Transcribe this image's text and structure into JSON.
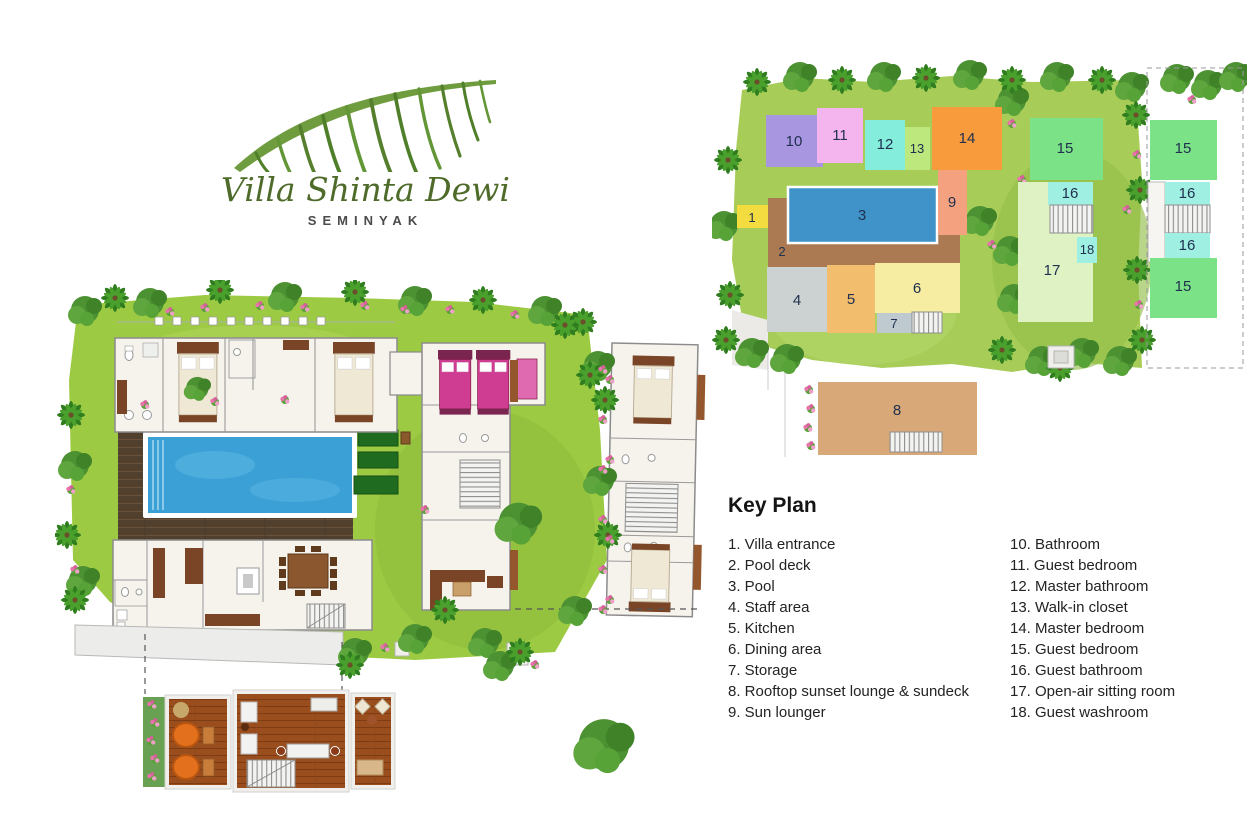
{
  "logo": {
    "title": "Villa Shinta Dewi",
    "subtitle": "SEMINYAK"
  },
  "legend": {
    "title": "Key Plan",
    "left": [
      "1. Villa entrance",
      "2. Pool deck",
      "3. Pool",
      "4. Staff area",
      "5. Kitchen",
      "6. Dining area",
      "7. Storage",
      "8. Rooftop sunset lounge & sundeck",
      "9. Sun lounger"
    ],
    "right": [
      "10. Bathroom",
      "11. Guest bedroom",
      "12. Master bathroom",
      "13. Walk-in closet",
      "14. Master bedroom",
      "15. Guest bedroom",
      "16. Guest bathroom",
      "17. Open-air sitting room",
      "18. Guest washroom"
    ]
  },
  "key_plan": {
    "rooms": {
      "1": {
        "label": "1",
        "name": "Villa entrance",
        "color": "#f2dc40"
      },
      "2": {
        "label": "2",
        "name": "Pool deck",
        "color": "#ab7a52"
      },
      "3": {
        "label": "3",
        "name": "Pool",
        "color": "#3f93c8"
      },
      "4": {
        "label": "4",
        "name": "Staff area",
        "color": "#ccd2d1"
      },
      "5": {
        "label": "5",
        "name": "Kitchen",
        "color": "#f2bd6d"
      },
      "6": {
        "label": "6",
        "name": "Dining area",
        "color": "#f6eda2"
      },
      "7": {
        "label": "7",
        "name": "Storage",
        "color": "#becacf"
      },
      "8": {
        "label": "8",
        "name": "Rooftop sunset lounge & sundeck",
        "color": "#d9a878"
      },
      "9": {
        "label": "9",
        "name": "Sun lounger",
        "color": "#f4a180"
      },
      "10": {
        "label": "10",
        "name": "Bathroom",
        "color": "#a996e0"
      },
      "11": {
        "label": "11",
        "name": "Guest bedroom",
        "color": "#f4b5ee"
      },
      "12": {
        "label": "12",
        "name": "Master bathroom",
        "color": "#84eddc"
      },
      "13": {
        "label": "13",
        "name": "Walk-in closet",
        "color": "#bce87e"
      },
      "14": {
        "label": "14",
        "name": "Master bedroom",
        "color": "#f79b3d"
      },
      "15": {
        "label": "15",
        "name": "Guest bedroom",
        "color": "#7ce287"
      },
      "16": {
        "label": "16",
        "name": "Guest bathroom",
        "color": "#9ff0e2"
      },
      "17": {
        "label": "17",
        "name": "Open-air sitting room",
        "color": "#def2c3"
      },
      "18": {
        "label": "18",
        "name": "Guest washroom",
        "color": "#9ff0e2"
      }
    }
  },
  "palette": {
    "grass_main": "#9dca43",
    "grass_key": "#a7cd58",
    "pool_water": "#3aa0d6",
    "deck_wood": "#52402e",
    "rooftop_wood": "#9b4e1d",
    "tree_green": "#4c9132",
    "flower_pink": "#e874ab",
    "logo_green": "#4e6b2a"
  }
}
